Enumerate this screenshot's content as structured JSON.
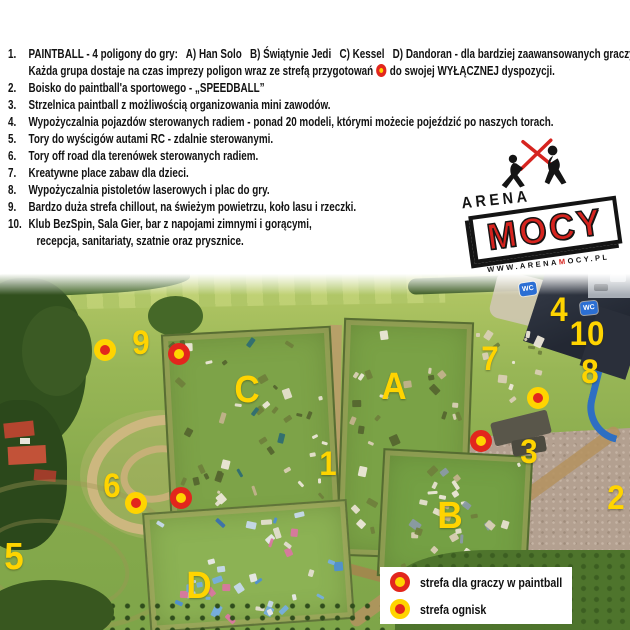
{
  "header": {
    "list": [
      {
        "num": "1.",
        "line1": "PAINTBALL - 4 poligony do gry:   A) Han Solo   B) Świątynie Jedi   C) Kessel   D) Dandoran - dla bardziej zaawansowanych graczy.",
        "line2_pre": "Każda grupa dostaje na czas imprezy poligon wraz ze strefą przygotowań",
        "line2_post": "do swojej WYŁĄCZNEJ dyspozycji."
      },
      {
        "num": "2.",
        "line1": "Boisko do paintball'a sportowego - „SPEEDBALL”"
      },
      {
        "num": "3.",
        "line1": "Strzelnica paintball z możliwością organizowania mini zawodów."
      },
      {
        "num": "4.",
        "line1": "Wypożyczalnia pojazdów sterowanych radiem - ponad 20 modeli, którymi możecie pojeździć po naszych torach."
      },
      {
        "num": "5.",
        "line1": "Tory do wyścigów autami RC - zdalnie sterowanymi."
      },
      {
        "num": "6.",
        "line1": "Tory off road dla terenówek sterowanych radiem."
      },
      {
        "num": "7.",
        "line1": "Kreatywne place zabaw dla dzieci."
      },
      {
        "num": "8.",
        "line1": "Wypożyczalnia pistoletów laserowych i plac do gry."
      },
      {
        "num": "9.",
        "line1": "Bardzo duża strefa chillout, na świeżym powietrzu, koło lasu i rzeczki."
      },
      {
        "num": "10.",
        "line1": "Klub BezSpin, Sala Gier, bar z napojami zimnymi i gorącymi,",
        "line2": "recepcja, sanitariaty, szatnie oraz prysznice."
      }
    ]
  },
  "logo": {
    "top": "ARENA",
    "main": "MOCY",
    "url_pre": "WWW.ARENA",
    "url_m": "M",
    "url_post": "OCY.PL"
  },
  "map": {
    "wc_label": "WC",
    "labels": [
      {
        "text": "1",
        "x": 328,
        "y": 464,
        "size": 34
      },
      {
        "text": "2",
        "x": 616,
        "y": 498,
        "size": 34
      },
      {
        "text": "3",
        "x": 529,
        "y": 452,
        "size": 34
      },
      {
        "text": "4",
        "x": 559,
        "y": 310,
        "size": 34
      },
      {
        "text": "5",
        "x": 14,
        "y": 557,
        "size": 38
      },
      {
        "text": "6",
        "x": 112,
        "y": 486,
        "size": 34
      },
      {
        "text": "7",
        "x": 490,
        "y": 359,
        "size": 34
      },
      {
        "text": "8",
        "x": 590,
        "y": 372,
        "size": 34
      },
      {
        "text": "9",
        "x": 141,
        "y": 343,
        "size": 34
      },
      {
        "text": "10",
        "x": 587,
        "y": 334,
        "size": 34
      },
      {
        "text": "A",
        "x": 394,
        "y": 387,
        "size": 38
      },
      {
        "text": "B",
        "x": 450,
        "y": 516,
        "size": 38
      },
      {
        "text": "C",
        "x": 247,
        "y": 390,
        "size": 38
      },
      {
        "text": "D",
        "x": 199,
        "y": 586,
        "size": 38
      }
    ],
    "markers": [
      {
        "type": "paintball",
        "x": 179,
        "y": 354
      },
      {
        "type": "paintball",
        "x": 481,
        "y": 441
      },
      {
        "type": "paintball",
        "x": 181,
        "y": 498
      },
      {
        "type": "bonfire",
        "x": 105,
        "y": 350
      },
      {
        "type": "bonfire",
        "x": 538,
        "y": 398
      },
      {
        "type": "bonfire",
        "x": 136,
        "y": 503
      }
    ],
    "wc_signs": [
      {
        "x": 528,
        "y": 289,
        "rot": -8
      },
      {
        "x": 589,
        "y": 308,
        "rot": -6
      }
    ],
    "legend": {
      "items": [
        {
          "type": "paintball",
          "label": "strefa dla graczy w paintball"
        },
        {
          "type": "bonfire",
          "label": "strefa ognisk"
        }
      ]
    },
    "colors": {
      "label_yellow": "#ffd400",
      "marker_red": "#e2261d",
      "marker_yellow": "#ffd400",
      "wc_blue": "#2b6fd4"
    }
  }
}
